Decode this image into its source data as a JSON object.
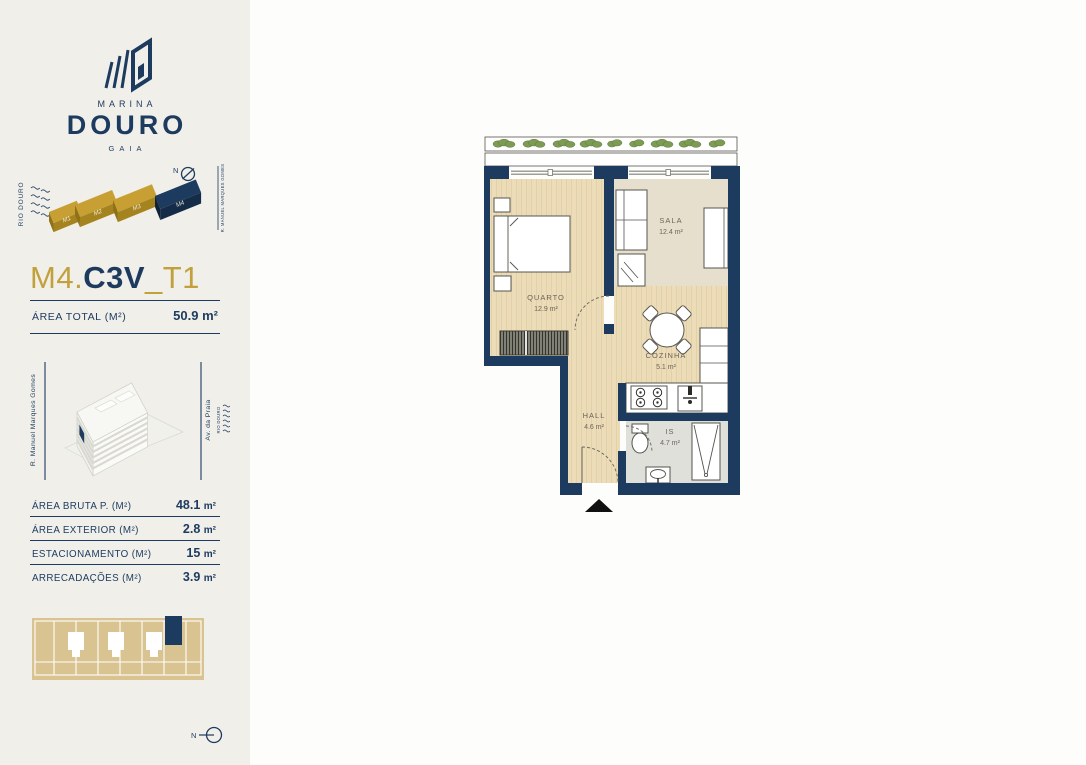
{
  "brand": {
    "marina": "MARINA",
    "douro": "DOURO",
    "gaia": "GAIA"
  },
  "masterplan": {
    "river": "RIO DOURO",
    "north": "N",
    "street": "R. MANUEL MARQUES GOMES",
    "blocks": [
      {
        "label": "M1",
        "highlight": false
      },
      {
        "label": "M2",
        "highlight": false
      },
      {
        "label": "M3",
        "highlight": false
      },
      {
        "label": "M4",
        "highlight": true
      }
    ]
  },
  "unit_title": {
    "block": "M4.",
    "code": "C3V",
    "typology": "_T1"
  },
  "area_total": {
    "label": "ÁREA TOTAL  (M²)",
    "value": "50.9",
    "unit": "m²"
  },
  "location_view": {
    "street_left": "R. Manuel Marques Gomes",
    "street_right": "Av. da Praia",
    "river": "RIO DOURO"
  },
  "areas_table": {
    "rows": [
      {
        "label": "ÁREA BRUTA P.  (M²)",
        "value": "48.1",
        "unit": "m²"
      },
      {
        "label": "ÁREA EXTERIOR (M²)",
        "value": "2.8",
        "unit": "m²"
      },
      {
        "label": "ESTACIONAMENTO (M²)",
        "value": "15",
        "unit": "m²"
      },
      {
        "label": "ARRECADAÇÕES (M²)",
        "value": "3.9",
        "unit": "m²"
      }
    ]
  },
  "floor_plan": {
    "rooms": [
      {
        "name": "QUARTO",
        "area": "12.9 m²"
      },
      {
        "name": "SALA",
        "area": "12.4 m²"
      },
      {
        "name": "COZINHA",
        "area": "5.1 m²"
      },
      {
        "name": "HALL",
        "area": "4.6 m²"
      },
      {
        "name": "IS",
        "area": "4.7 m²"
      }
    ]
  },
  "compass_bottom": {
    "label": "N"
  },
  "colors": {
    "navy": "#1d3a5f",
    "gold": "#c2a13c",
    "sand": "#d9c390"
  }
}
